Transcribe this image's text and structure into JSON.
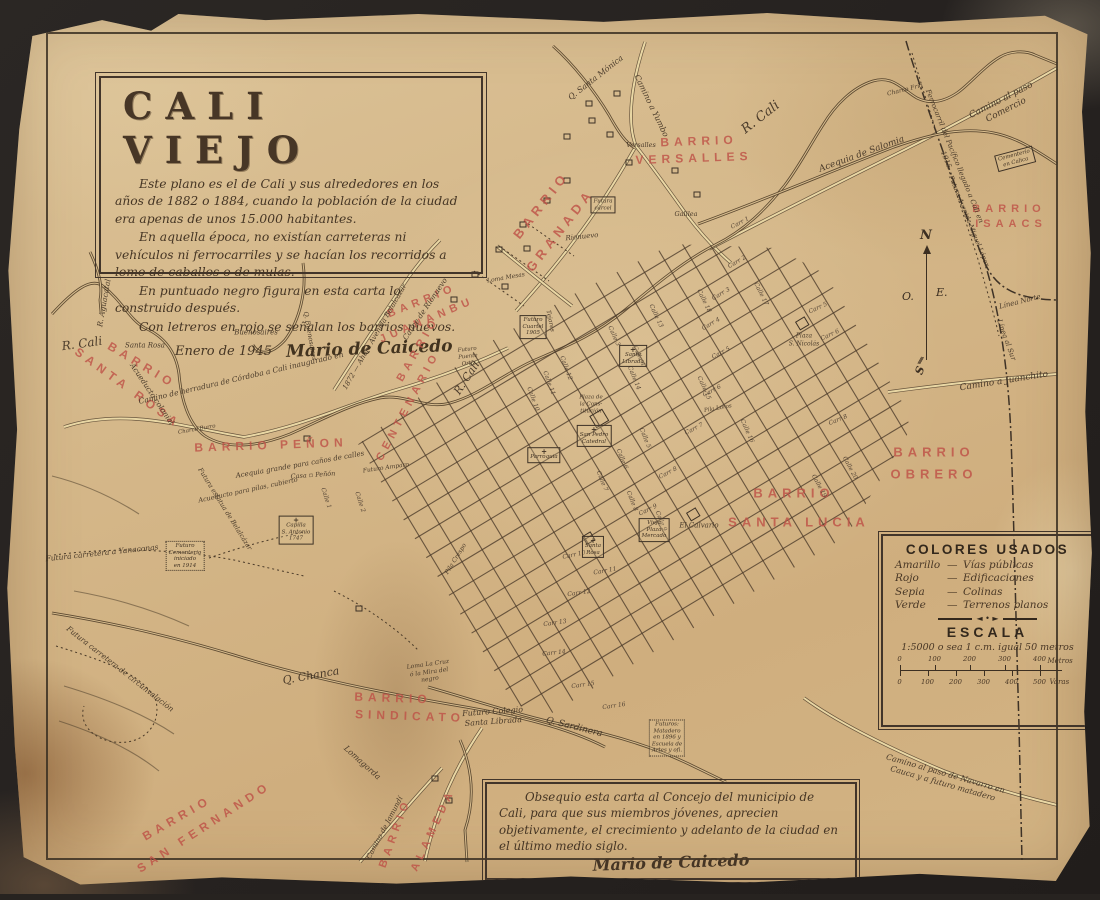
{
  "photo": {
    "background_color": "#272320",
    "paper_color": "#d5b88a",
    "ink_color": "#3c2f22",
    "red_color": "#bf5348",
    "road_color": "#e9d7a4"
  },
  "title_block": {
    "title": "CALI VIEJO",
    "paragraphs": [
      "Este plano es el de Cali y sus alrededores en los años de 1882 o 1884, cuando la población de la ciudad era apenas de unos 15.000 habitantes.",
      "En aquella época, no existían carreteras ni vehículos ni ferrocarriles y se hacían los recorridos a lomo de caballos o de mulas.",
      "En puntuado negro figura en esta carta lo construido después.",
      "Con letreros en rojo se señalan los barrios nuevos."
    ],
    "date": "Enero de 1945",
    "signature": "Mario de Caicedo"
  },
  "dedication": {
    "text": "Obsequio esta carta al Concejo del municipio de Cali, para que sus miembros jóvenes, aprecien objetivamente, el crecimiento y adelanto de la ciudad en el último medio siglo.",
    "signature": "Mario de Caicedo"
  },
  "legend": {
    "title": "COLORES USADOS",
    "entries": [
      {
        "name": "Amarillo",
        "meaning": "Vías públicas"
      },
      {
        "name": "Rojo",
        "meaning": "Edificaciones"
      },
      {
        "name": "Sepia",
        "meaning": "Colinas"
      },
      {
        "name": "Verde",
        "meaning": "Terrenos planos"
      }
    ],
    "ornament": "◄ • ►",
    "escala_title": "ESCALA",
    "scale_text": "1:5000 o sea 1 c.m. igual 50 metros",
    "meters": {
      "ticks": [
        "0",
        "100",
        "200",
        "300",
        "400"
      ],
      "unit": "Metros"
    },
    "varas": {
      "ticks": [
        "0",
        "100",
        "200",
        "300",
        "400",
        "500"
      ],
      "unit": "Varas"
    }
  },
  "compass": {
    "north": "N",
    "south": "S",
    "east": "E.",
    "west": "O.",
    "tail": "///"
  },
  "barrio_labels": [
    {
      "text": "BARRIO",
      "x": 695,
      "y": 135,
      "rot": -2,
      "size": 12
    },
    {
      "text": "VERSALLES",
      "x": 690,
      "y": 152,
      "rot": -2,
      "size": 12
    },
    {
      "text": "BARRIO",
      "x": 537,
      "y": 199,
      "rot": -52,
      "size": 13
    },
    {
      "text": "GRANADA",
      "x": 556,
      "y": 224,
      "rot": -52,
      "size": 13
    },
    {
      "text": "BARRIO",
      "x": 418,
      "y": 295,
      "rot": -22,
      "size": 11
    },
    {
      "text": "JUANANBU",
      "x": 423,
      "y": 314,
      "rot": -23,
      "size": 11
    },
    {
      "text": "BARRIO",
      "x": 414,
      "y": 343,
      "rot": -60,
      "size": 11
    },
    {
      "text": "CENTENARIO",
      "x": 404,
      "y": 400,
      "rot": -62,
      "size": 11
    },
    {
      "text": "BARRIO",
      "x": 138,
      "y": 359,
      "rot": 31,
      "size": 12
    },
    {
      "text": "SANTA ROSA",
      "x": 124,
      "y": 382,
      "rot": 36,
      "size": 12
    },
    {
      "text": "BARRIO PEÑON",
      "x": 267,
      "y": 439,
      "rot": -2,
      "size": 12
    },
    {
      "text": "BARRIO",
      "x": 1005,
      "y": 203,
      "rot": 0,
      "size": 11
    },
    {
      "text": "ISAACS",
      "x": 1007,
      "y": 218,
      "rot": 0,
      "size": 11
    },
    {
      "text": "BARRIO",
      "x": 930,
      "y": 446,
      "rot": 0,
      "size": 13
    },
    {
      "text": "OBRERO",
      "x": 930,
      "y": 468,
      "rot": 0,
      "size": 13
    },
    {
      "text": "BARRIO",
      "x": 790,
      "y": 487,
      "rot": 0,
      "size": 13
    },
    {
      "text": "SANTA LUCIA",
      "x": 795,
      "y": 516,
      "rot": 0,
      "size": 13
    },
    {
      "text": "BARRIO",
      "x": 389,
      "y": 692,
      "rot": 2,
      "size": 12
    },
    {
      "text": "SINDICATO",
      "x": 406,
      "y": 710,
      "rot": 2,
      "size": 12
    },
    {
      "text": "BARRIO",
      "x": 173,
      "y": 812,
      "rot": -30,
      "size": 12
    },
    {
      "text": "SAN FERNANDO",
      "x": 200,
      "y": 821,
      "rot": -33,
      "size": 12
    },
    {
      "text": "BARRIO",
      "x": 391,
      "y": 827,
      "rot": -70,
      "size": 11
    },
    {
      "text": "ALAMEDA",
      "x": 429,
      "y": 824,
      "rot": -65,
      "size": 11
    }
  ],
  "map_labels": [
    {
      "text": "R. Cali",
      "x": 78,
      "y": 338,
      "rot": -8,
      "size": 12
    },
    {
      "text": "R. Cali",
      "x": 757,
      "y": 112,
      "rot": -38,
      "size": 13
    },
    {
      "text": "R. Cali",
      "x": 463,
      "y": 372,
      "rot": -57,
      "size": 11
    },
    {
      "text": "R. Aguacatal",
      "x": 100,
      "y": 297,
      "rot": -80,
      "size": 7.5
    },
    {
      "text": "Q. Santa Mónica",
      "x": 592,
      "y": 72,
      "rot": -38,
      "size": 8
    },
    {
      "text": "Camino a Yumbo",
      "x": 647,
      "y": 100,
      "rot": 64,
      "size": 8
    },
    {
      "text": "Camino al paso Comercio",
      "x": 1000,
      "y": 100,
      "rot": -27,
      "size": 9
    },
    {
      "text": "Ferrocarril del Pacífico llegado a Cali en 1915",
      "x": 946,
      "y": 152,
      "rot": 68,
      "size": 7
    },
    {
      "text": "Futura Avenida Miguel López",
      "x": 965,
      "y": 215,
      "rot": 68,
      "size": 6.5
    },
    {
      "text": "Línea Norte",
      "x": 1016,
      "y": 296,
      "rot": -14,
      "size": 7
    },
    {
      "text": "Línea al Sur",
      "x": 1002,
      "y": 334,
      "rot": 70,
      "size": 7
    },
    {
      "text": "Camino a Juanchito",
      "x": 1000,
      "y": 376,
      "rot": -9,
      "size": 9
    },
    {
      "text": "Acequia de Salomia",
      "x": 858,
      "y": 149,
      "rot": -20,
      "size": 9
    },
    {
      "text": "Charco Frío",
      "x": 901,
      "y": 84,
      "rot": -14,
      "size": 6
    },
    {
      "text": "Versalles",
      "x": 637,
      "y": 139,
      "rot": 0,
      "size": 6.5
    },
    {
      "text": "Galilea",
      "x": 682,
      "y": 208,
      "rot": 0,
      "size": 6.5
    },
    {
      "text": "Rionuevo",
      "x": 578,
      "y": 231,
      "rot": -6,
      "size": 7
    },
    {
      "text": "Cauce de Rionuevo",
      "x": 421,
      "y": 303,
      "rot": -56,
      "size": 7.5
    },
    {
      "text": "Camino de herradura de Córdoba a Cali inaugurado en",
      "x": 237,
      "y": 372,
      "rot": -13,
      "size": 7.5
    },
    {
      "text": "1872 — Ahora Avenida Belalcázar",
      "x": 371,
      "y": 331,
      "rot": -60,
      "size": 7
    },
    {
      "text": "Acueducto colonial",
      "x": 148,
      "y": 388,
      "rot": 56,
      "size": 7.5
    },
    {
      "text": "Santa Rosa",
      "x": 141,
      "y": 340,
      "rot": 0,
      "size": 7
    },
    {
      "text": "Buenosaires",
      "x": 252,
      "y": 327,
      "rot": 0,
      "size": 7
    },
    {
      "text": "Q. Buenosaires",
      "x": 306,
      "y": 330,
      "rot": 80,
      "size": 6.5
    },
    {
      "text": "Charco Burro",
      "x": 193,
      "y": 424,
      "rot": -10,
      "size": 5.5
    },
    {
      "text": "Acequia grande para caños de calles",
      "x": 296,
      "y": 459,
      "rot": -10,
      "size": 7
    },
    {
      "text": "Casa ▫ Peñón",
      "x": 309,
      "y": 469,
      "rot": -4,
      "size": 6.5
    },
    {
      "text": "Acueducto para pilas, cubierto",
      "x": 244,
      "y": 484,
      "rot": -12,
      "size": 6.5
    },
    {
      "text": "Futuro Amparo",
      "x": 382,
      "y": 462,
      "rot": -8,
      "size": 6
    },
    {
      "text": "Futura carretera a Yanaconas",
      "x": 98,
      "y": 547,
      "rot": -6,
      "size": 7.5
    },
    {
      "text": "Futura estatua de Belalcázar",
      "x": 221,
      "y": 503,
      "rot": 58,
      "size": 6.5
    },
    {
      "text": "Loma Mesas",
      "x": 502,
      "y": 272,
      "rot": -10,
      "size": 6
    },
    {
      "text": "Tejares",
      "x": 546,
      "y": 315,
      "rot": 78,
      "size": 6
    },
    {
      "text": "Q. Chanca",
      "x": 307,
      "y": 670,
      "rot": -10,
      "size": 11
    },
    {
      "text": "Futura carretera de circunvalación",
      "x": 116,
      "y": 663,
      "rot": 38,
      "size": 7.5
    },
    {
      "text": "Lomagorda",
      "x": 358,
      "y": 757,
      "rot": 42,
      "size": 8
    },
    {
      "text": "Loma La Cruz\nó la Mira del\nnegro",
      "x": 425,
      "y": 666,
      "rot": -8,
      "size": 6
    },
    {
      "text": "Camino de Jamundí",
      "x": 381,
      "y": 822,
      "rot": -62,
      "size": 7
    },
    {
      "text": "Futuro Colegio\nSanta Librada",
      "x": 489,
      "y": 711,
      "rot": -4,
      "size": 8
    },
    {
      "text": "Q. Sardinera",
      "x": 570,
      "y": 722,
      "rot": 14,
      "size": 9
    },
    {
      "text": "Camino al paso de Navarro en Cauca y a futuro matadero",
      "x": 940,
      "y": 773,
      "rot": 16,
      "size": 8
    },
    {
      "text": "El Calvario",
      "x": 695,
      "y": 520,
      "rot": 0,
      "size": 7
    },
    {
      "text": "Plaza de\nla Cons-\ntitución",
      "x": 587,
      "y": 399,
      "rot": 0,
      "size": 5.5
    },
    {
      "text": "Plaza\nS. Nicolás",
      "x": 800,
      "y": 334,
      "rot": 0,
      "size": 6
    },
    {
      "text": "Pila Crespo",
      "x": 452,
      "y": 553,
      "rot": -58,
      "size": 6
    },
    {
      "text": "Pila Loros",
      "x": 714,
      "y": 403,
      "rot": -10,
      "size": 5.5
    },
    {
      "text": "Futuro\nPuente\nOrtiz",
      "x": 464,
      "y": 351,
      "rot": -6,
      "size": 5.5
    }
  ],
  "street_labels": [
    {
      "text": "Carr 1",
      "x": 736,
      "y": 217,
      "rot": -28
    },
    {
      "text": "Carr 2",
      "x": 733,
      "y": 256,
      "rot": -30
    },
    {
      "text": "Carr 3",
      "x": 717,
      "y": 288,
      "rot": -30
    },
    {
      "text": "Carr 4",
      "x": 707,
      "y": 318,
      "rot": -30
    },
    {
      "text": "Carr 5",
      "x": 717,
      "y": 347,
      "rot": -28
    },
    {
      "text": "Carr 5",
      "x": 814,
      "y": 302,
      "rot": -25
    },
    {
      "text": "Carr 6",
      "x": 826,
      "y": 329,
      "rot": -25
    },
    {
      "text": "Carr 6",
      "x": 708,
      "y": 385,
      "rot": -28
    },
    {
      "text": "Carr 7",
      "x": 690,
      "y": 423,
      "rot": -28
    },
    {
      "text": "Carr 8",
      "x": 834,
      "y": 414,
      "rot": -22
    },
    {
      "text": "Carr 8",
      "x": 664,
      "y": 467,
      "rot": -28
    },
    {
      "text": "Carr 9",
      "x": 644,
      "y": 504,
      "rot": -26
    },
    {
      "text": "Carr 10",
      "x": 570,
      "y": 549,
      "rot": -12
    },
    {
      "text": "Carr 11",
      "x": 601,
      "y": 565,
      "rot": -10
    },
    {
      "text": "Carr 12",
      "x": 575,
      "y": 587,
      "rot": -8
    },
    {
      "text": "Carr 13",
      "x": 551,
      "y": 617,
      "rot": -8
    },
    {
      "text": "Carr 14",
      "x": 550,
      "y": 647,
      "rot": -6
    },
    {
      "text": "Carr 15",
      "x": 579,
      "y": 679,
      "rot": -8
    },
    {
      "text": "Carr 16",
      "x": 610,
      "y": 700,
      "rot": -8
    },
    {
      "text": "Calle 1",
      "x": 322,
      "y": 492,
      "rot": 72
    },
    {
      "text": "Calle 2",
      "x": 356,
      "y": 496,
      "rot": 72
    },
    {
      "text": "Calle 3",
      "x": 610,
      "y": 330,
      "rot": 66
    },
    {
      "text": "Calle 4",
      "x": 635,
      "y": 350,
      "rot": 66
    },
    {
      "text": "Calle 5",
      "x": 641,
      "y": 432,
      "rot": 68
    },
    {
      "text": "Calle 6",
      "x": 618,
      "y": 453,
      "rot": 68
    },
    {
      "text": "Calle 7",
      "x": 598,
      "y": 475,
      "rot": 68
    },
    {
      "text": "Calle 8",
      "x": 628,
      "y": 495,
      "rot": 68
    },
    {
      "text": "Calle 9",
      "x": 657,
      "y": 515,
      "rot": 68
    },
    {
      "text": "Calle 10",
      "x": 529,
      "y": 393,
      "rot": 70
    },
    {
      "text": "Calle 11",
      "x": 545,
      "y": 377,
      "rot": 70
    },
    {
      "text": "Calle 12",
      "x": 562,
      "y": 362,
      "rot": 70
    },
    {
      "text": "Calle 13",
      "x": 652,
      "y": 310,
      "rot": 65
    },
    {
      "text": "Calle 14",
      "x": 630,
      "y": 372,
      "rot": 68
    },
    {
      "text": "Calle 15",
      "x": 700,
      "y": 382,
      "rot": 66
    },
    {
      "text": "Calle 16",
      "x": 743,
      "y": 425,
      "rot": 66
    },
    {
      "text": "Calle 17",
      "x": 757,
      "y": 288,
      "rot": 64
    },
    {
      "text": "Calle 18",
      "x": 700,
      "y": 295,
      "rot": 64
    },
    {
      "text": "Calle 19",
      "x": 815,
      "y": 480,
      "rot": 62
    },
    {
      "text": "Calle 20",
      "x": 846,
      "y": 462,
      "rot": 62
    }
  ],
  "landmarks": [
    {
      "label": "Futura\ncárcel",
      "x": 599,
      "y": 199,
      "type": "plain",
      "rot": 0
    },
    {
      "label": "Futuro\nCuartel\n1905",
      "x": 529,
      "y": 321,
      "type": "plain",
      "rot": 0
    },
    {
      "label": "San Pedro\nCatedral",
      "x": 590,
      "y": 430,
      "type": "cross",
      "rot": 0
    },
    {
      "label": "Santa\nRosa",
      "x": 589,
      "y": 541,
      "type": "cross",
      "rot": 0
    },
    {
      "label": "Santa\nLibrada",
      "x": 629,
      "y": 350,
      "type": "cross",
      "rot": 0
    },
    {
      "label": "Parroquia",
      "x": 540,
      "y": 449,
      "type": "cross",
      "rot": 0
    },
    {
      "label": "Capilla\nS. Antonio\n1747",
      "x": 292,
      "y": 524,
      "type": "cross",
      "rot": 0
    },
    {
      "label": "Cementerio\nen Calica",
      "x": 1011,
      "y": 153,
      "type": "plain",
      "rot": -15
    },
    {
      "label": "Futuro\nCementerio\niniciado\nen 1914",
      "x": 181,
      "y": 550,
      "type": "dotted",
      "rot": 0
    },
    {
      "label": "Futuros:\nMatadero\nen 1896 y\nEscuela de\nArtes y ofi.",
      "x": 663,
      "y": 732,
      "type": "dotted",
      "rot": 0
    },
    {
      "label": "Vieja\nPlaza\nMercado",
      "x": 650,
      "y": 524,
      "type": "plain",
      "rot": 0
    }
  ]
}
